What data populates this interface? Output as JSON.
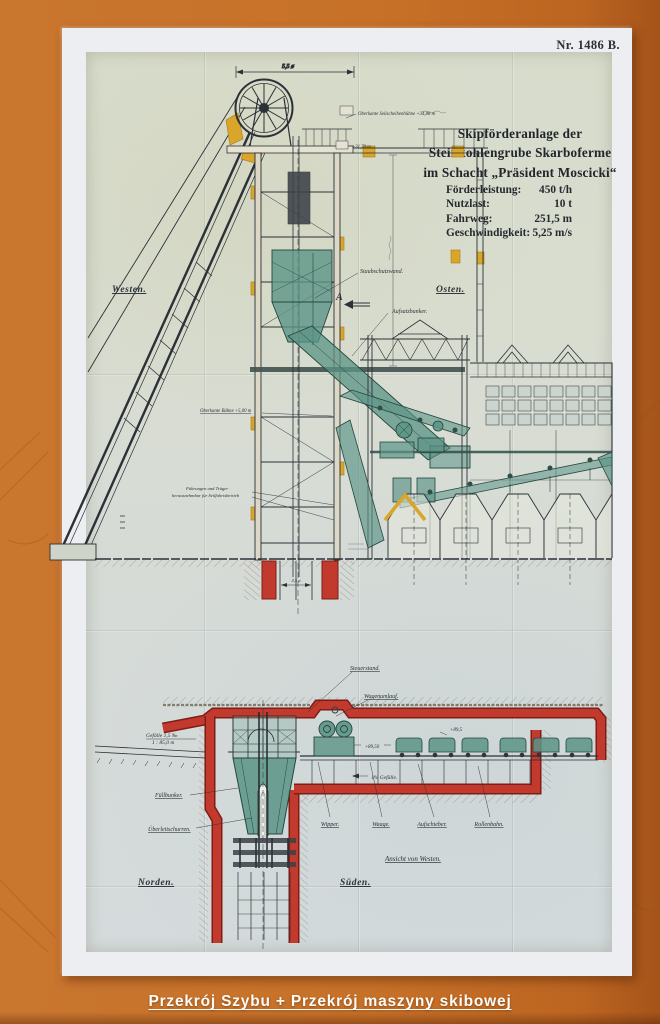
{
  "plate": {
    "number": "Nr. 1486 B."
  },
  "title_block": {
    "line1": "Skipförderanlage der",
    "line2": "Steinkohlengrube Skarboferme",
    "line3": "im Schacht „Präsident Moscicki“",
    "specs": [
      {
        "label": "Förderleistung:",
        "value": "450 t/h"
      },
      {
        "label": "Nutzlast:",
        "value": "10 t"
      },
      {
        "label": "Fahrweg:",
        "value": "251,5 m"
      },
      {
        "label": "Geschwindigkeit:",
        "value": "5,25 m/s"
      }
    ]
  },
  "upper_drawing": {
    "west": "Westen.",
    "east": "Osten.",
    "dim_wheel": "5,5 ø",
    "note_sheave": "Oberkante Seilscheibenbühne +34,88 m",
    "note_level": "+31,70 m",
    "note_wall": "Staubschutzwand.",
    "note_bunker": "Aufsatzbunker.",
    "note_platform": "Oberkante Bühne +5,00 m",
    "note_guides_1": "Führungen und Träger",
    "note_guides_2": "herausnehmbar für Seilfahrtsbetrieb",
    "section_marker": "A",
    "collar_dim": "4,5 ø"
  },
  "lower_drawing": {
    "gefaelle_1": "Gefälle 1,5 ‰",
    "gefaelle_2": "1 : 85,0 m",
    "steuerstand": "Steuerstand.",
    "wagenumlauf": "Wagenumlauf.",
    "fuellbunker": "Füllbunker.",
    "ueberleitschurren": "Überleitschurren.",
    "elev_mid": "+89,50",
    "elev_right": "+89,5",
    "gefaelle_3": "1% Gefälle.",
    "wipper": "Wipper.",
    "waage": "Waage.",
    "aufschieber": "Aufschieber.",
    "rollenbahn": "Rollenbahn.",
    "ansicht": "Ansicht von Westen.",
    "norden": "Norden.",
    "sueden": "Süden."
  },
  "caption": {
    "text": "Przekrój Szybu + Przekrój maszyny skibowej"
  },
  "palette": {
    "orange_bg": "#c77128",
    "mat_white": "#eceef2",
    "paper": "#d8dccf",
    "ink": "#2b3137",
    "red_lining": "#c23a2e",
    "teal_machinery": "#5b9486",
    "ochre_steel": "#d9a52b"
  }
}
